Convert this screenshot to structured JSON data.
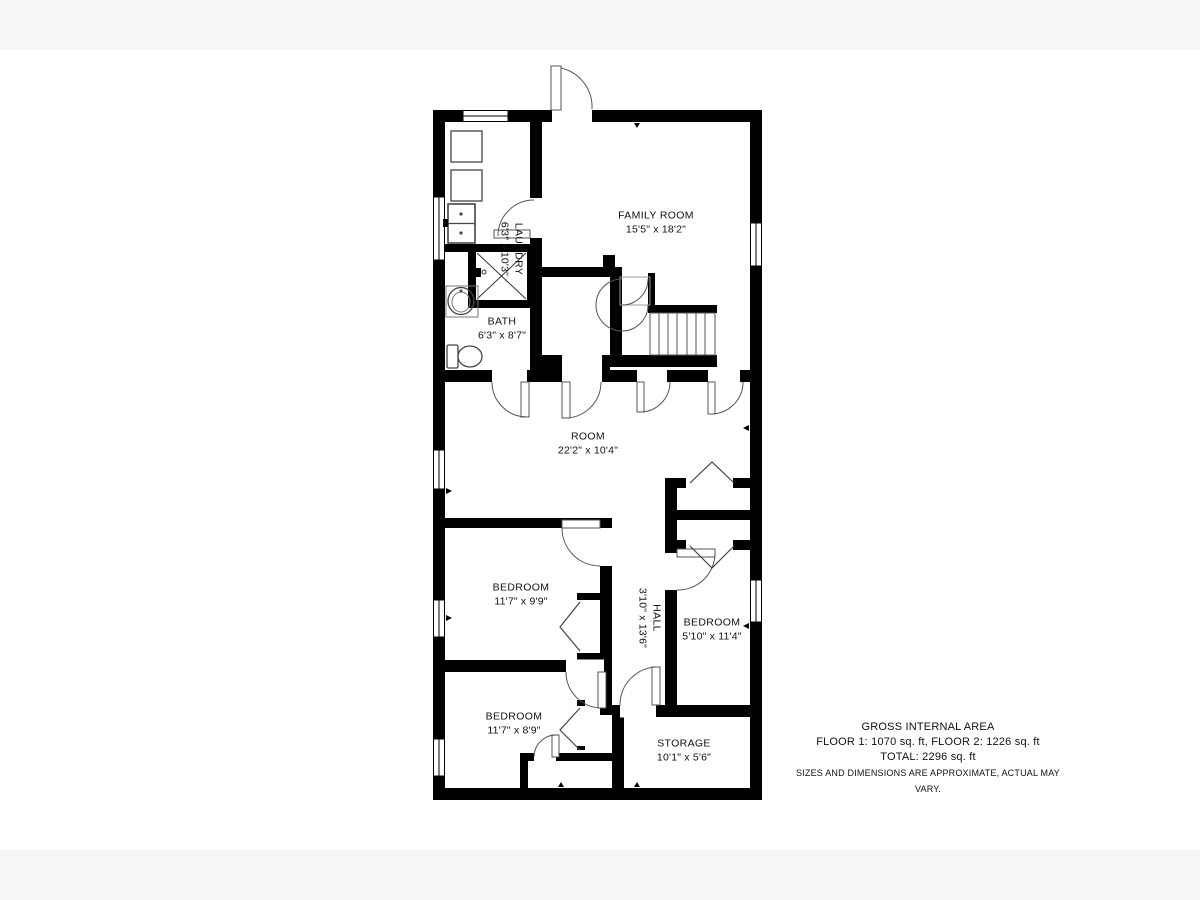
{
  "plan": {
    "rooms": [
      {
        "name": "LAUNDRY",
        "dims": "6'3\" x 10'3\""
      },
      {
        "name": "FAMILY ROOM",
        "dims": "15'5\" x 18'2\""
      },
      {
        "name": "BATH",
        "dims": "6'3\" x 8'7\""
      },
      {
        "name": "ROOM",
        "dims": "22'2\" x 10'4\""
      },
      {
        "name": "BEDROOM",
        "dims": "11'7\" x 9'9\""
      },
      {
        "name": "HALL",
        "dims": "3'10\" x 13'6\""
      },
      {
        "name": "BEDROOM",
        "dims": "5'10\" x 11'4\""
      },
      {
        "name": "BEDROOM",
        "dims": "11'7\" x 8'9\""
      },
      {
        "name": "STORAGE",
        "dims": "10'1\" x 5'6\""
      }
    ],
    "footer": {
      "title": "GROSS INTERNAL AREA",
      "floors": "FLOOR 1: 1070 sq. ft, FLOOR 2: 1226 sq. ft",
      "total": "TOTAL: 2296 sq. ft",
      "disclaimer": "SIZES AND DIMENSIONS ARE APPROXIMATE, ACTUAL MAY VARY."
    },
    "fixtures": [
      "entry-door",
      "washer",
      "dryer",
      "laundry-sink",
      "shower",
      "bath-sink",
      "toilet",
      "staircase",
      "window",
      "bifold-closet-door"
    ],
    "colors": {
      "wall": "#000000",
      "background": "#ffffff",
      "band": "#f6f5f8",
      "line": "#555555"
    }
  }
}
